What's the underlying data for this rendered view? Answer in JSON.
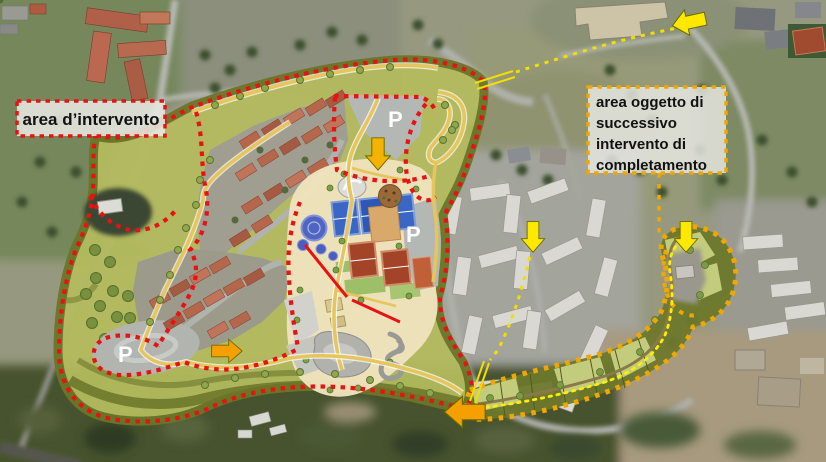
{
  "labels": {
    "intervention": "area d’intervento",
    "completion": [
      "area oggetto di",
      "successivo",
      "intervento di",
      "completamento"
    ]
  },
  "annotations": {
    "intervention_area": {
      "label": "area d’intervento",
      "boundary_style": "red dashed"
    },
    "completion_area": {
      "label": "area oggetto di successivo intervento di completamento",
      "boundary_style": "yellow dotted"
    },
    "parking": [
      "P",
      "P",
      "P"
    ],
    "arrows": [
      {
        "id": "arrow-top-right",
        "direction": "left",
        "color": "yellow"
      },
      {
        "id": "arrow-plan-north-entrance",
        "direction": "down",
        "color": "orange-yellow"
      },
      {
        "id": "arrow-route-mid",
        "direction": "down",
        "color": "yellow"
      },
      {
        "id": "arrow-completion-north",
        "direction": "down",
        "color": "yellow"
      },
      {
        "id": "arrow-west-parking",
        "direction": "right",
        "color": "orange"
      },
      {
        "id": "arrow-junction-south",
        "direction": "left",
        "color": "orange"
      }
    ]
  },
  "colors": {
    "intervention_boundary": "#e81212",
    "completion_boundary": "#f0a700",
    "route_dotted": "#f2de00",
    "arrow_yellow": "#ffe800",
    "arrow_orange": "#f5a000",
    "arrow_orangeyellow": "#f5b301",
    "park_green": "#b4bb5e",
    "park_dark": "#6b7629",
    "path_yellow": "#e6c55c",
    "plan_cream": "#f0e2bd",
    "parking_letter": "#ffffff"
  }
}
